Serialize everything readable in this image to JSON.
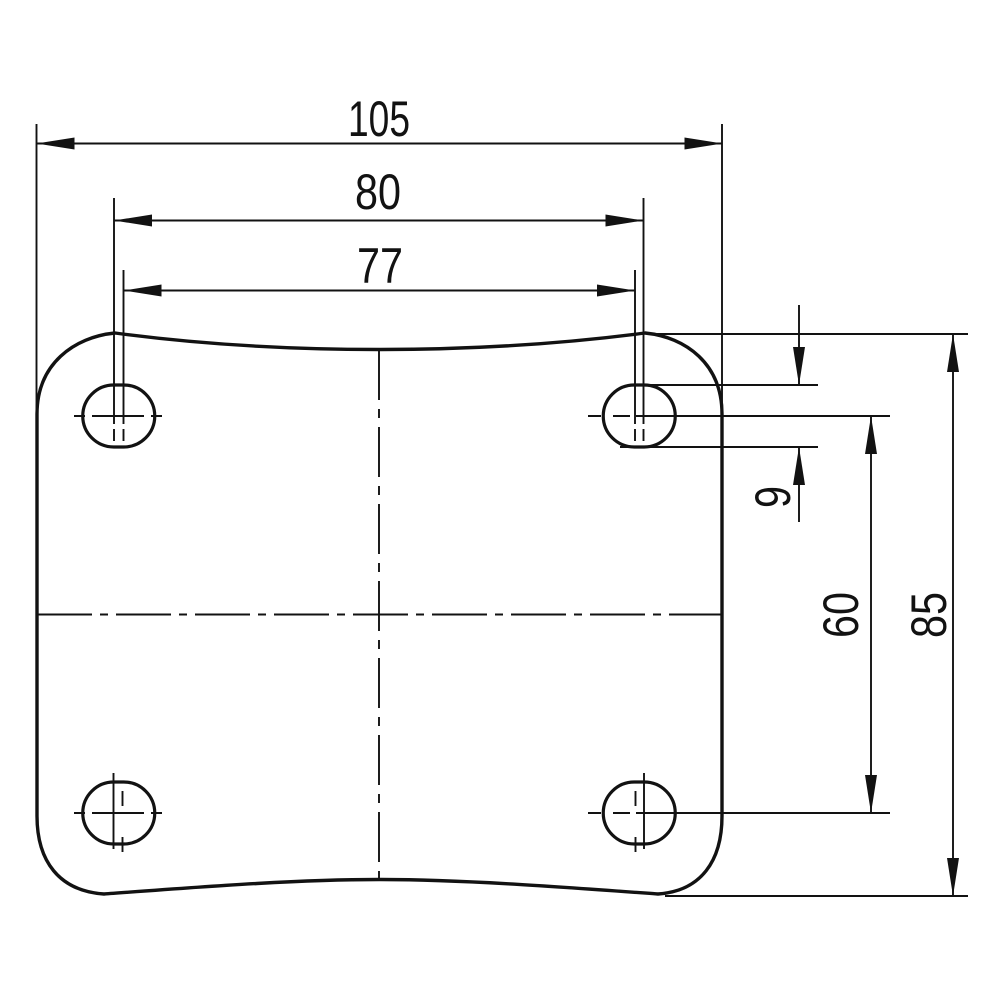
{
  "drawing": {
    "kind": "technical-dimension-drawing",
    "view": "mounting-plate-top-view",
    "colors": {
      "ink": "#121212",
      "paper": "#ffffff"
    },
    "dims": {
      "plate_width": "105",
      "hole_pitch_outer": "80",
      "hole_pitch_inner": "77",
      "hole_diameter": "9",
      "hole_pitch_vertical": "60",
      "plate_height": "85"
    }
  }
}
